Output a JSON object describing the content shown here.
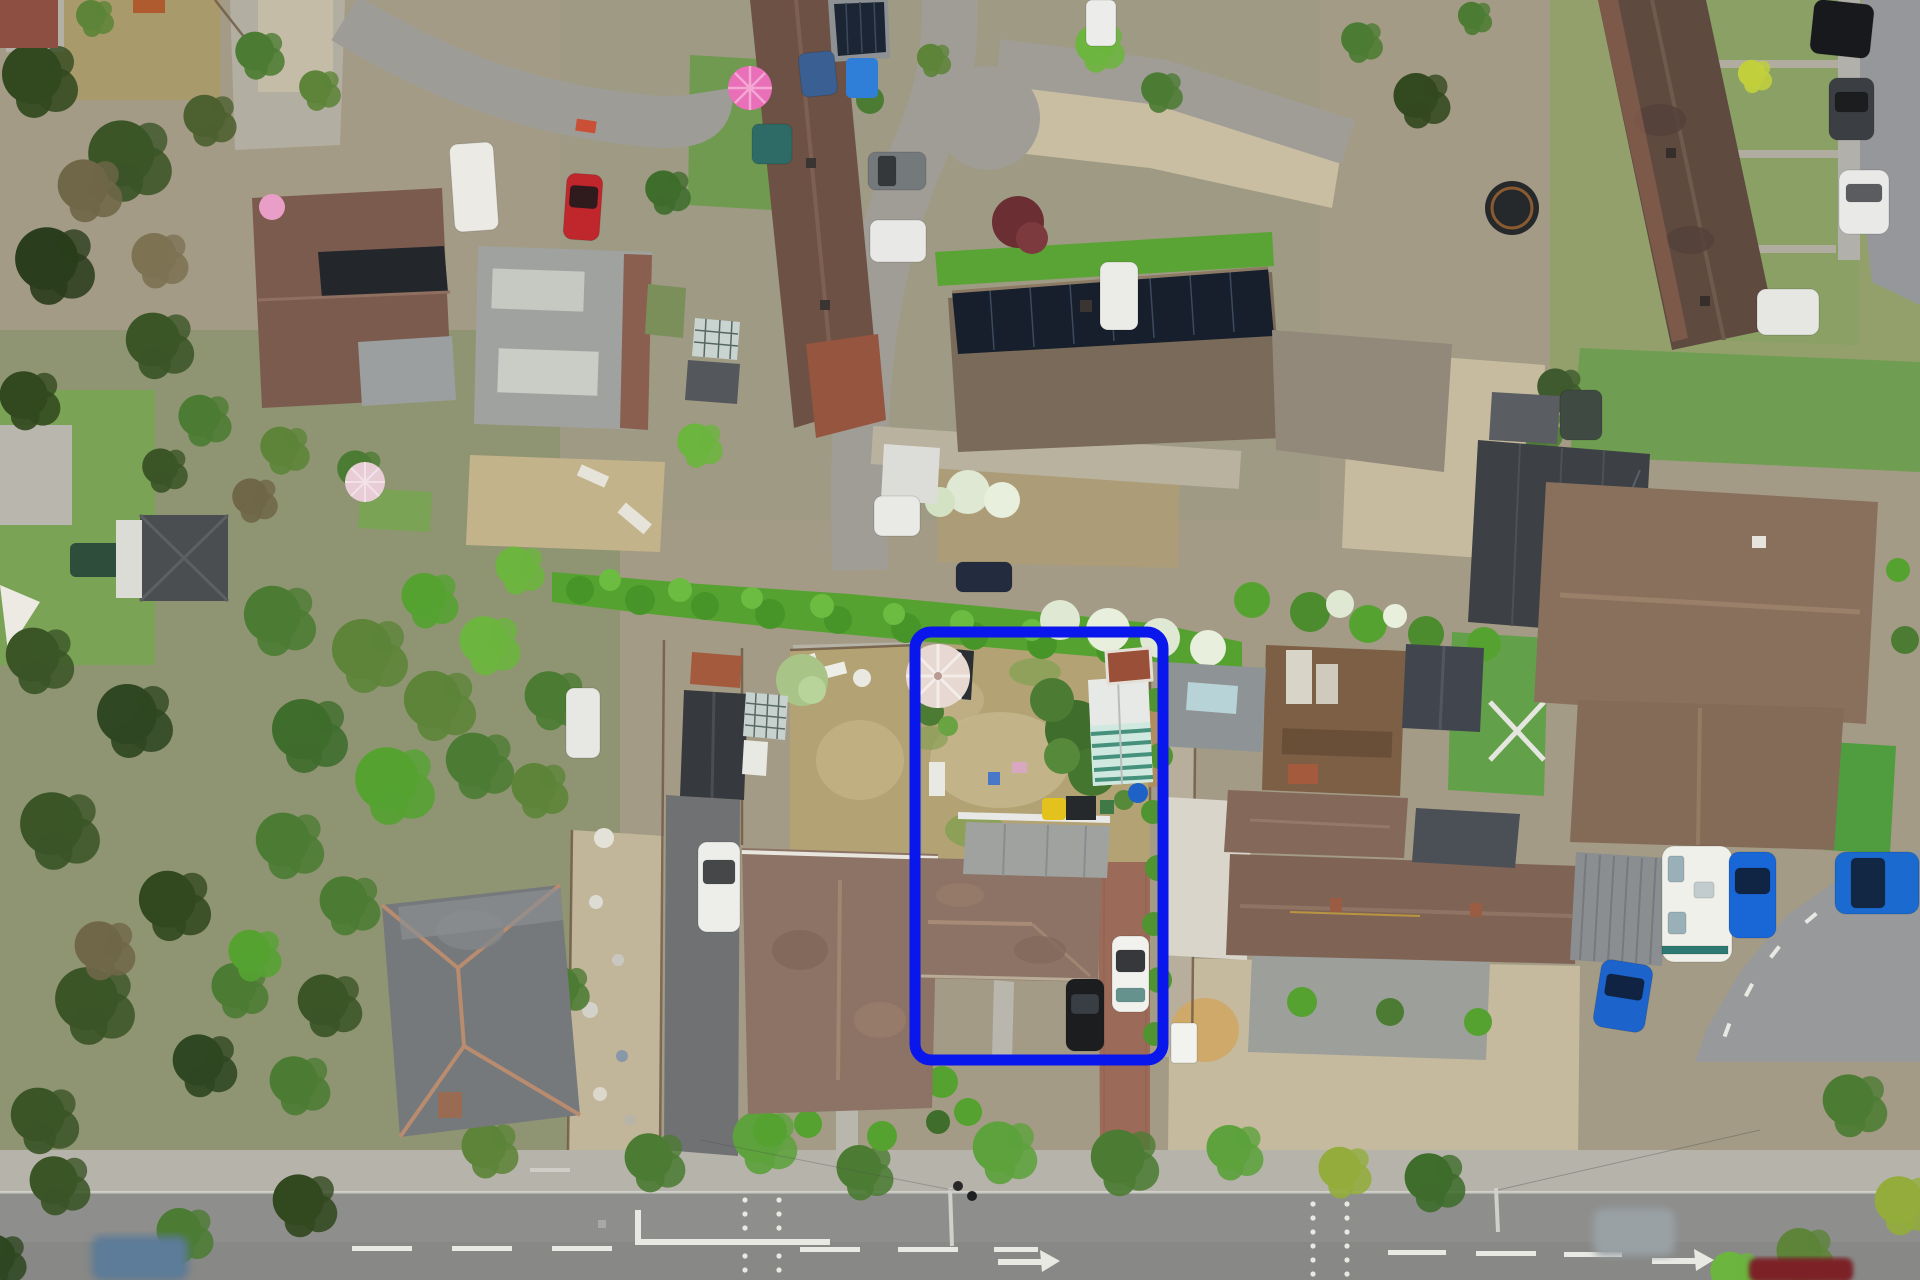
{
  "meta": {
    "type": "aerial-drone-photograph",
    "subject": "top-down aerial view of a residential neighbourhood with one plot outlined",
    "text_content": "none (photograph contains no visible text)"
  },
  "overlay": {
    "boundary": {
      "label": "highlighted-property-boundary",
      "x": 915,
      "y": 632,
      "w": 248,
      "h": 428,
      "rx": 16,
      "stroke_width": 11,
      "color": "#0916ec"
    }
  },
  "palette": {
    "base": "#a39b85",
    "road": "#989894",
    "road_main": "#8e8e8c",
    "sidewalk": "#b6b3ab",
    "gravel": "#c9bea1",
    "dry_lawn": "#b3a374",
    "lawn": "#7ba355",
    "artificial_lawn": "#4f9d3f",
    "hedge_bright": "#55a231",
    "tree_mid": "#4c7c33",
    "tree_dark": "#32491f",
    "tree_dead": "#6f6748",
    "blossom": "#dfe8d3",
    "roof_brown_dark": "#6d5145",
    "roof_terraced_right": "#5f4a40",
    "roof_taupe": "#92897b",
    "roof_big_house": "#89705d",
    "roof_bungalow": "#8d7365",
    "roof_neighbour": "#7f6456",
    "slate_roof": "#75797b",
    "gray_roof": "#9fa29e",
    "charcoal_roof": "#3d4145",
    "solar_panel": "#161f2b",
    "white_flat_roof": "#d9d5cb",
    "brick_driveway": "#9b6a58",
    "marking_white": "#e9e9e4"
  },
  "scene": {
    "road_markings": {
      "centre_dashed_line": true,
      "right_turn_arrows": 2,
      "dotted_lane_columns": 4,
      "junction_stop_line": true
    },
    "vehicles": [
      {
        "id": "red-car-top-left",
        "color": "#c0272d"
      },
      {
        "id": "white-van-top-left",
        "color": "#eceae4"
      },
      {
        "id": "teal-car-terrace",
        "color": "#2e6b66"
      },
      {
        "id": "gray-suv-terrace",
        "color": "#74797c"
      },
      {
        "id": "white-car-terrace",
        "color": "#e8e8e6"
      },
      {
        "id": "white-car-culdesac",
        "color": "#ebebe8"
      },
      {
        "id": "white-van-top",
        "color": "#ececea"
      },
      {
        "id": "black-suv-right-road",
        "color": "#17191c"
      },
      {
        "id": "gray-car-right-road",
        "color": "#3b3f43"
      },
      {
        "id": "white-car-right-road",
        "color": "#e9e9e7"
      },
      {
        "id": "white-car-right-road-2",
        "color": "#e6e6e3"
      },
      {
        "id": "white-car-neighbour-drive",
        "color": "#ededea"
      },
      {
        "id": "white-car-target-drive",
        "color": "#f1f1ee"
      },
      {
        "id": "black-car-target-drive",
        "color": "#1b1d1f"
      },
      {
        "id": "white-caravan",
        "color": "#f0f0ea"
      },
      {
        "id": "blue-car-1",
        "color": "#1966d6"
      },
      {
        "id": "blue-car-2",
        "color": "#1b6ad0"
      },
      {
        "id": "blue-car-3",
        "color": "#1c64cc"
      },
      {
        "id": "moving-car-main-road",
        "color": "#9aa1a5"
      },
      {
        "id": "dark-red-car-main-road",
        "color": "#7c2428"
      },
      {
        "id": "blue-blurred-car-left",
        "color": "#5b7b99"
      },
      {
        "id": "white-car-by-fence",
        "color": "#e7e7e3"
      },
      {
        "id": "dark-blue-car-hedge-gap",
        "color": "#232b3e"
      },
      {
        "id": "white-car-mid-drive",
        "color": "#e9e9e6"
      },
      {
        "id": "blue-van-top",
        "color": "#3a5f92"
      },
      {
        "id": "dark-car-under-tree",
        "color": "#3f4a42"
      },
      {
        "id": "white-trailer-outside-boundary",
        "color": "#f2f2ef"
      }
    ],
    "garden_features": [
      {
        "id": "white-parasol-target-garden",
        "color": "#e7d8d2"
      },
      {
        "id": "pink-parasol-terrace-garden",
        "color": "#e86fb8"
      },
      {
        "id": "pink-parasol-top-left-garden",
        "color": "#e89ec6"
      },
      {
        "id": "pale-parasol-left-garden",
        "color": "#e8cdd6"
      },
      {
        "id": "striped-greenhouse-target",
        "color": "#46917c"
      },
      {
        "id": "hot-tub-right-garden",
        "color": "#26292c"
      },
      {
        "id": "blue-barrel-target",
        "color": "#1e62c8"
      },
      {
        "id": "yellow-sack-target",
        "color": "#e3c21e"
      }
    ]
  }
}
